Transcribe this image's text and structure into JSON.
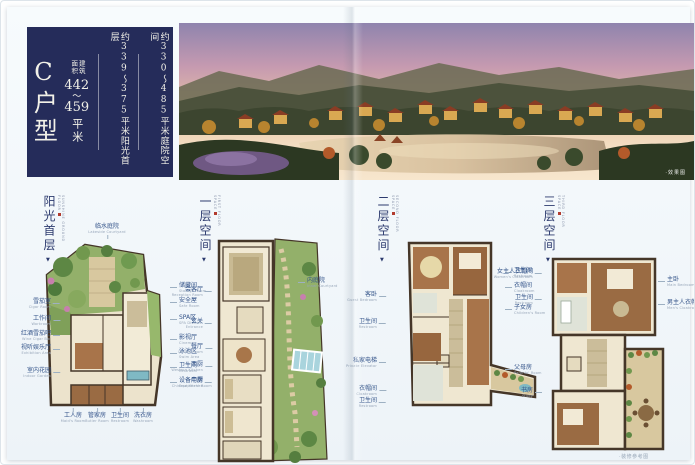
{
  "cover": {
    "unit_type": "C户型",
    "area_title": "建筑面积",
    "area_from": "442",
    "tilde": "～",
    "area_to": "459",
    "area_unit": "平米",
    "sunshine_line": "约339～375平米阳光首层",
    "courtyard_line": "约330～485平米庭院空间"
  },
  "photo": {
    "caption": "·效果图"
  },
  "footer": {
    "caption": "·装修参考图"
  },
  "colors": {
    "navy": "#252c5a",
    "accent_red": "#b23b2e",
    "label_blue": "#35558a",
    "garden_green": "#93b06a",
    "floor_tan": "#efe7d1",
    "water_blue": "#7fb9c4"
  },
  "sections": [
    {
      "x": 36,
      "title": "阳光首层",
      "subtitle": "SUNSHINE GROUND FLOOR",
      "marker": "▼"
    },
    {
      "x": 192,
      "title": "一层空间",
      "subtitle": "FIRST FLOOR SPACE",
      "marker": "▼"
    },
    {
      "x": 370,
      "title": "二层空间",
      "subtitle": "SECOND FLOOR SPACE",
      "marker": "▼"
    },
    {
      "x": 536,
      "title": "三层空间",
      "subtitle": "THIRD FLOOR SPACE",
      "marker": "▼"
    }
  ],
  "room_labels": [
    {
      "side": "T",
      "x": 100,
      "y": 217,
      "cn": "临水庭院",
      "en": "Lakeside Courtyard"
    },
    {
      "side": "L",
      "x": 54,
      "y": 292,
      "cn": "雪茄室",
      "en": "Cigar Room"
    },
    {
      "side": "L",
      "x": 54,
      "y": 309,
      "cn": "工作间",
      "en": "Workroom"
    },
    {
      "side": "L",
      "x": 54,
      "y": 324,
      "cn": "红酒雪茄吧",
      "en": "Wine Cigar Bar"
    },
    {
      "side": "L",
      "x": 54,
      "y": 338,
      "cn": "视听娱乐厅",
      "en": "Exhibition Area"
    },
    {
      "side": "L",
      "x": 54,
      "y": 361,
      "cn": "室内花园",
      "en": "Indoor Garden"
    },
    {
      "side": "R",
      "x": 162,
      "y": 276,
      "cn": "储藏间",
      "en": "Storage Room"
    },
    {
      "side": "R",
      "x": 162,
      "y": 291,
      "cn": "安全屋",
      "en": "Safe Room"
    },
    {
      "side": "R",
      "x": 162,
      "y": 308,
      "cn": "SPA区",
      "en": "SPA District"
    },
    {
      "side": "R",
      "x": 162,
      "y": 328,
      "cn": "影视厅",
      "en": "Cinema"
    },
    {
      "side": "R",
      "x": 162,
      "y": 342,
      "cn": "泳池区",
      "en": "Swim Area"
    },
    {
      "side": "R",
      "x": 162,
      "y": 356,
      "cn": "卫生间",
      "en": "Restroom"
    },
    {
      "side": "R",
      "x": 162,
      "y": 371,
      "cn": "设备用房",
      "en": "Equipment Room"
    },
    {
      "side": "C",
      "x": 66,
      "y": 406,
      "cn": "工人房",
      "en": "Maid's Room"
    },
    {
      "side": "C",
      "x": 90,
      "y": 406,
      "cn": "管家房",
      "en": "Butler Room"
    },
    {
      "side": "C",
      "x": 113,
      "y": 406,
      "cn": "卫生间",
      "en": "Restroom"
    },
    {
      "side": "C",
      "x": 136,
      "y": 406,
      "cn": "洗衣房",
      "en": "Washroom"
    },
    {
      "side": "L",
      "x": 206,
      "y": 280,
      "cn": "会客厅",
      "en": "Reception Room"
    },
    {
      "side": "L",
      "x": 206,
      "y": 312,
      "cn": "玄关",
      "en": "Entrance"
    },
    {
      "side": "L",
      "x": 206,
      "y": 337,
      "cn": "餐厅",
      "en": "Dining Room"
    },
    {
      "side": "L",
      "x": 206,
      "y": 355,
      "cn": "西厨",
      "en": "Western Kitchen"
    },
    {
      "side": "L",
      "x": 206,
      "y": 371,
      "cn": "中厨",
      "en": "Chinese Kitchen"
    },
    {
      "side": "R",
      "x": 290,
      "y": 271,
      "cn": "内庭院",
      "en": "Inner Courtyard"
    },
    {
      "side": "L",
      "x": 380,
      "y": 285,
      "cn": "客卧",
      "en": "Guest Bedroom"
    },
    {
      "side": "L",
      "x": 380,
      "y": 312,
      "cn": "卫生间",
      "en": "Restroom"
    },
    {
      "side": "L",
      "x": 380,
      "y": 351,
      "cn": "私家电梯",
      "en": "Private Elevator"
    },
    {
      "side": "L",
      "x": 380,
      "y": 379,
      "cn": "衣帽间",
      "en": "Cloakroom"
    },
    {
      "side": "L",
      "x": 380,
      "y": 391,
      "cn": "卫生间",
      "en": "Restroom"
    },
    {
      "side": "R",
      "x": 497,
      "y": 261,
      "cn": "卫生间",
      "en": "Restroom"
    },
    {
      "side": "R",
      "x": 497,
      "y": 276,
      "cn": "衣帽间",
      "en": "Cloakroom"
    },
    {
      "side": "R",
      "x": 497,
      "y": 298,
      "cn": "子女房",
      "en": "Children's Room"
    },
    {
      "side": "R",
      "x": 497,
      "y": 358,
      "cn": "父母房",
      "en": "Parents' Room"
    },
    {
      "side": "L",
      "x": 536,
      "y": 262,
      "cn": "女主人衣帽间",
      "en": "Women's Cloakroom"
    },
    {
      "side": "L",
      "x": 536,
      "y": 288,
      "cn": "卫生间",
      "en": "Restroom"
    },
    {
      "side": "L",
      "x": 536,
      "y": 381,
      "cn": "书房",
      "en": "Study"
    },
    {
      "side": "R",
      "x": 650,
      "y": 270,
      "cn": "主卧",
      "en": "Main Bedroom"
    },
    {
      "side": "R",
      "x": 650,
      "y": 293,
      "cn": "男主人衣帽间",
      "en": "Men's Cloakroom"
    }
  ]
}
